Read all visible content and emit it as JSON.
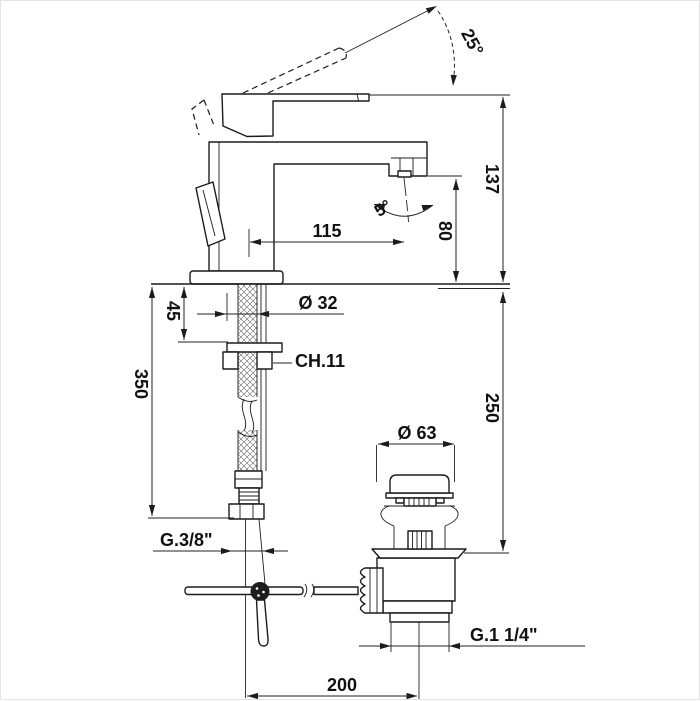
{
  "drawing": {
    "colors": {
      "line": "#1c1c1c",
      "background": "#ffffff"
    },
    "dims": {
      "lever_angle": "25°",
      "total_height": "137",
      "spout_height": "80",
      "spout_reach": "115",
      "spray_angle": "5°",
      "shank_diameter": "Ø 32",
      "wrench_size": "CH.11",
      "deck_thickness": "45",
      "hose_length": "350",
      "drain_height": "250",
      "waste_cap_diameter": "Ø 63",
      "supply_thread": "G.3/8\"",
      "waste_thread": "G.1 1/4\"",
      "drain_offset": "200"
    }
  }
}
